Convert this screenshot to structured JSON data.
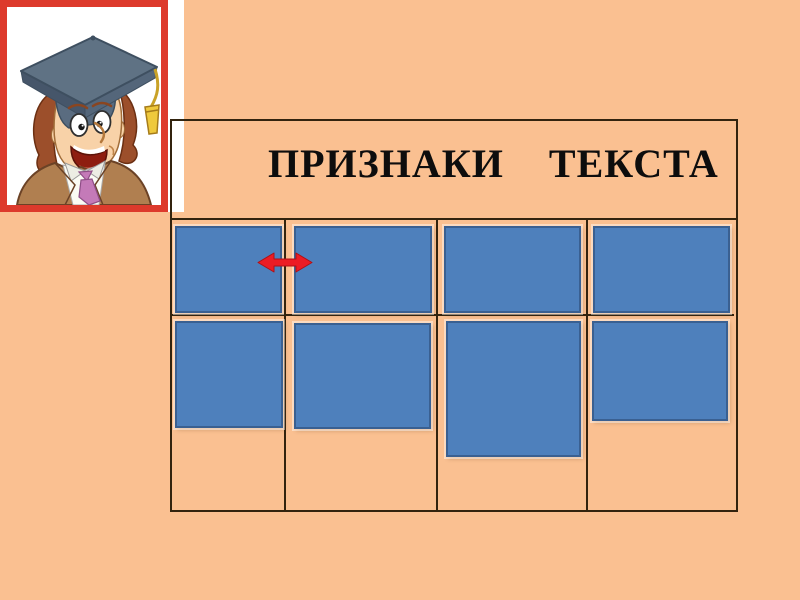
{
  "slide": {
    "background_color": "#FAC091"
  },
  "table": {
    "title": "ПРИЗНАКИ ТЕКСТА",
    "title_color": "#0D0D0D",
    "border_color": "#32230E",
    "columns": 4,
    "rows": 2,
    "header_merged": true,
    "cells_text": [
      "",
      "",
      "",
      "",
      "",
      "",
      "",
      ""
    ]
  },
  "cards": {
    "count": 8,
    "fill_color": "#4E80BC",
    "border_color": "#3A6091",
    "note": "blank blue cover rectangles hiding answers"
  },
  "arrow": {
    "type": "left-right-double-arrow",
    "color": "#EC1C24",
    "position": "between first and second card of top row"
  },
  "picture": {
    "description": "cartoon boy wearing graduation mortarboard cap with yellow tassel, brown jacket, pink tie",
    "frame_color": "#DD3A2C",
    "background_color": "#FFFFFF"
  }
}
